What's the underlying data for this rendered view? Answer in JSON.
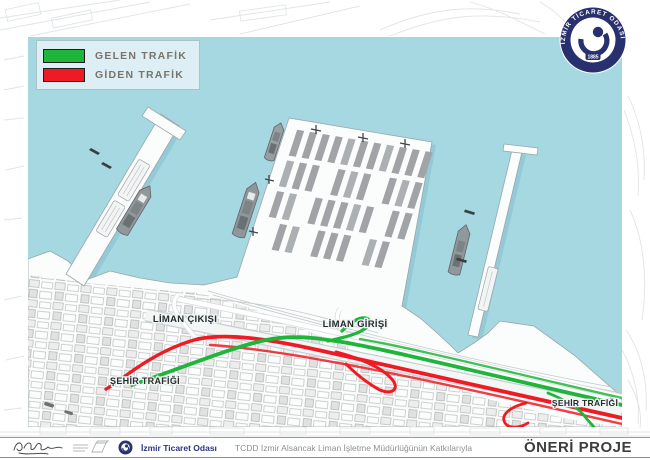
{
  "legend": {
    "items": [
      {
        "label": "GELEN TRAFİK",
        "color": "#1fb53a"
      },
      {
        "label": "GİDEN TRAFİK",
        "color": "#ee1b24"
      }
    ]
  },
  "map": {
    "labels": {
      "port_exit": "LİMAN ÇIKIŞI",
      "port_entry": "LİMAN GİRİŞİ",
      "city_traffic_left": "ŞEHİR TRAFİĞİ",
      "city_traffic_right": "ŞEHİR TRAFİĞİ"
    },
    "colors": {
      "water": "#a6d8e2",
      "incoming_green": "#1fb53a",
      "outgoing_red": "#ee1b24"
    }
  },
  "logo": {
    "ring_text": "İZMİR TİCARET ODASI",
    "year": "1885"
  },
  "footer": {
    "org_name": "İzmir Ticaret Odası",
    "credit": "TCDD İzmir Alsancak Liman İşletme Müdürlüğünün Katkılarıyla",
    "project_title": "ÖNERİ PROJE"
  }
}
